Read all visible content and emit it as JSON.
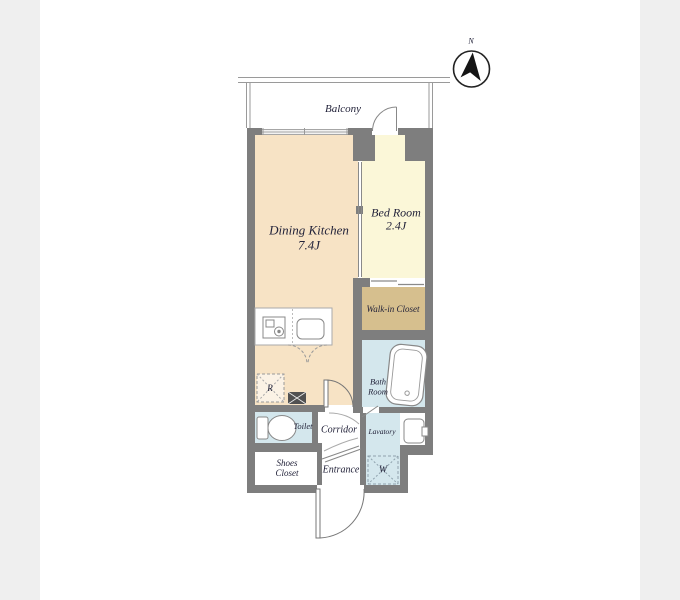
{
  "canvas": {
    "background": "#ffffff",
    "side_bar_color": "#efefef"
  },
  "compass": {
    "north_label": "N"
  },
  "balcony": {
    "label": "Balcony"
  },
  "rooms": {
    "dining_kitchen": {
      "label": "Dining Kitchen",
      "size": "7.4J",
      "floor_color": "#f7e3c5"
    },
    "bed_room": {
      "label": "Bed Room",
      "size": "2.4J",
      "floor_color": "#fbf7d8"
    },
    "walk_in_closet": {
      "label": "Walk-in Closet",
      "floor_color": "#d6bf8e"
    },
    "bath_room": {
      "line1": "Bath",
      "line2": "Room",
      "floor_color": "#d4e7ed"
    },
    "toilet": {
      "label": "Toilet",
      "floor_color": "#d4e7ed"
    },
    "corridor": {
      "label": "Corridor",
      "floor_color": "#ffffff"
    },
    "lavatory": {
      "label": "Lavatory",
      "floor_color": "#d4e7ed"
    },
    "shoes_closet": {
      "line1": "Shoes",
      "line2": "Closet",
      "floor_color": "#ffffff"
    },
    "entrance": {
      "label": "Entrance",
      "floor_color": "#ffffff"
    }
  },
  "symbols": {
    "refrigerator": "R",
    "washing_machine": "W"
  },
  "colors": {
    "wall": "#7e7e7e",
    "line": "#888888",
    "text": "#23233a"
  }
}
